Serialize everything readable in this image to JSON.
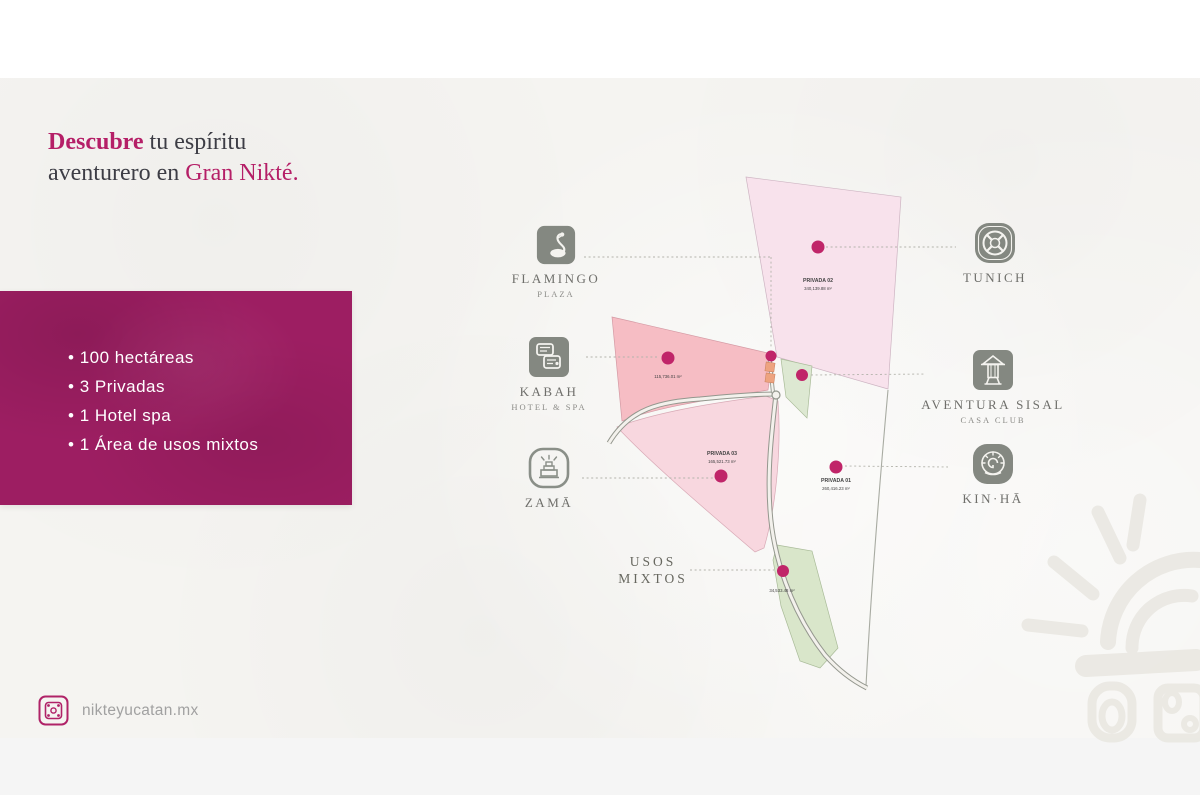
{
  "slide": {
    "heading": {
      "accent1": "Descubre",
      "rest1": " tu espíritu",
      "rest2": "aventurero en ",
      "accent2": "Gran Nikté."
    },
    "website": "nikteyucatan.mx"
  },
  "stats_panel": {
    "items": [
      "100 hectáreas",
      "3 Privadas",
      "1 Hotel spa",
      "1 Área de usos mixtos"
    ]
  },
  "locations": {
    "flamingo": {
      "label": "FLAMINGO",
      "sub": "PLAZA"
    },
    "tunich": {
      "label": "TUNICH"
    },
    "kabah": {
      "label": "KABAH",
      "sub": "HOTEL & SPA"
    },
    "aventura_sisal": {
      "label": "AVENTURA SISAL",
      "sub": "CASA CLUB"
    },
    "zama": {
      "label": "ZAMĀ"
    },
    "kinha": {
      "label": "KIN·HĀ"
    },
    "usos_mixtos": {
      "line1": "USOS",
      "line2": "MIXTOS"
    }
  },
  "parcels": {
    "privada02": {
      "name": "PRIVADA 02",
      "area": "340,139.88 m²"
    },
    "privada03": {
      "name": "PRIVADA 03",
      "area": "165,521.73 m²"
    },
    "privada01": {
      "name": "PRIVADA 01",
      "area": "260,416.23 m²"
    },
    "kabah_zone": {
      "area": "115,736.01 m²"
    },
    "usos_mixtos": {
      "area": "34,533.48 m²"
    }
  },
  "colors": {
    "accent": "#b51f67",
    "panel": "#9d1e62",
    "map_dot": "#c02569",
    "icon_gray": "#848881"
  }
}
